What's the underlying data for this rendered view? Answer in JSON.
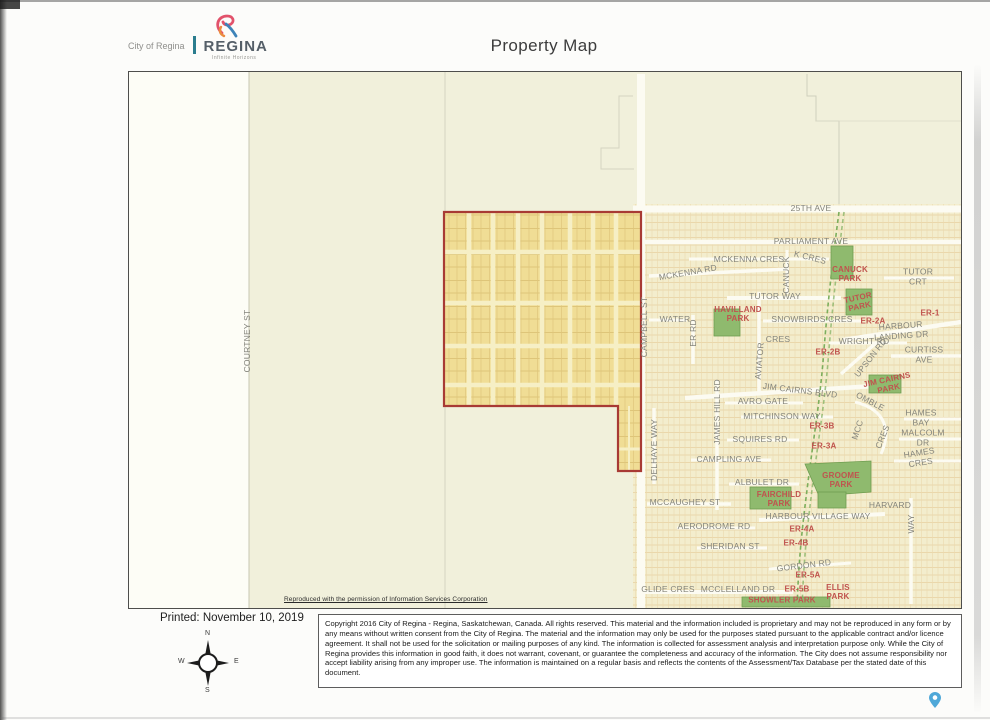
{
  "header": {
    "logo_small": "City of Regina",
    "logo_wordmark": "REGINA",
    "logo_tagline": "Infinite Horizons",
    "title": "Property Map"
  },
  "map": {
    "attribution": "Reproduced with the permission of Information Services Corporation",
    "labels": [
      {
        "t": "COURTNEY ST",
        "x": 119,
        "y": 269,
        "r": -90,
        "c": "s"
      },
      {
        "t": "CAMPBELL ST",
        "x": 516,
        "y": 255,
        "r": -90,
        "c": "s"
      },
      {
        "t": "25TH AVE",
        "x": 682,
        "y": 137,
        "r": 0,
        "c": "s"
      },
      {
        "t": "PARLIAMENT AVE",
        "x": 682,
        "y": 170,
        "r": 0,
        "c": "s"
      },
      {
        "t": "MCKENNA CRES",
        "x": 620,
        "y": 188,
        "r": 0,
        "c": "s"
      },
      {
        "t": "K CRES",
        "x": 681,
        "y": 186,
        "r": 14,
        "c": "s"
      },
      {
        "t": "CANUCK",
        "x": 658,
        "y": 203,
        "r": -90,
        "c": "s"
      },
      {
        "t": "MCKENNA RD",
        "x": 559,
        "y": 201,
        "r": -10,
        "c": "s"
      },
      {
        "t": "TUTOR CRT",
        "x": 789,
        "y": 205,
        "r": 0,
        "c": "s"
      },
      {
        "t": "TUTOR WAY",
        "x": 646,
        "y": 225,
        "r": 0,
        "c": "s"
      },
      {
        "t": "WATER",
        "x": 546,
        "y": 248,
        "r": 0,
        "c": "s"
      },
      {
        "t": "ER RD",
        "x": 565,
        "y": 261,
        "r": -90,
        "c": "s"
      },
      {
        "t": "SNOWBIRDS CRES",
        "x": 683,
        "y": 248,
        "r": 0,
        "c": "s"
      },
      {
        "t": "HARBOUR LANDING DR",
        "x": 772,
        "y": 259,
        "r": -4,
        "c": "s"
      },
      {
        "t": "WRIGHT RD",
        "x": 735,
        "y": 270,
        "r": 0,
        "c": "s"
      },
      {
        "t": "CRES",
        "x": 649,
        "y": 268,
        "r": 0,
        "c": "s"
      },
      {
        "t": "AVIATOR",
        "x": 631,
        "y": 289,
        "r": -85,
        "c": "s"
      },
      {
        "t": "CURTISS AVE",
        "x": 795,
        "y": 283,
        "r": 0,
        "c": "s"
      },
      {
        "t": "UPSON RD",
        "x": 742,
        "y": 286,
        "r": -52,
        "c": "s"
      },
      {
        "t": "JIM CAIRNS BLVD",
        "x": 671,
        "y": 319,
        "r": 7,
        "c": "s"
      },
      {
        "t": "AVRO GATE",
        "x": 634,
        "y": 330,
        "r": 0,
        "c": "s"
      },
      {
        "t": "OMBLE",
        "x": 741,
        "y": 330,
        "r": 28,
        "c": "s"
      },
      {
        "t": "MCC",
        "x": 729,
        "y": 358,
        "r": -72,
        "c": "s"
      },
      {
        "t": "CRES",
        "x": 754,
        "y": 365,
        "r": -68,
        "c": "s"
      },
      {
        "t": "MITCHINSON WAY",
        "x": 653,
        "y": 345,
        "r": 0,
        "c": "s"
      },
      {
        "t": "SQUIRES RD",
        "x": 631,
        "y": 368,
        "r": 0,
        "c": "s"
      },
      {
        "t": "CAMPLING AVE",
        "x": 600,
        "y": 388,
        "r": 0,
        "c": "s"
      },
      {
        "t": "JAMES HILL RD",
        "x": 589,
        "y": 340,
        "r": -90,
        "c": "s"
      },
      {
        "t": "DELHAYE WAY",
        "x": 526,
        "y": 378,
        "r": -90,
        "c": "s"
      },
      {
        "t": "HAMES BAY",
        "x": 792,
        "y": 346,
        "r": 0,
        "c": "s"
      },
      {
        "t": "MALCOLM DR",
        "x": 794,
        "y": 366,
        "r": 0,
        "c": "s"
      },
      {
        "t": "HAMES CRES",
        "x": 791,
        "y": 386,
        "r": -9,
        "c": "s"
      },
      {
        "t": "ALBULET DR",
        "x": 633,
        "y": 411,
        "r": 0,
        "c": "s"
      },
      {
        "t": "MCCAUGHEY ST",
        "x": 556,
        "y": 431,
        "r": 0,
        "c": "s"
      },
      {
        "t": "HARVARD",
        "x": 761,
        "y": 434,
        "r": 0,
        "c": "s"
      },
      {
        "t": "WAY",
        "x": 783,
        "y": 452,
        "r": -90,
        "c": "s"
      },
      {
        "t": "HARBOUR VILLAGE WAY",
        "x": 689,
        "y": 445,
        "r": 0,
        "c": "s"
      },
      {
        "t": "AERODROME RD",
        "x": 585,
        "y": 455,
        "r": 0,
        "c": "s"
      },
      {
        "t": "SHERIDAN ST",
        "x": 601,
        "y": 475,
        "r": 0,
        "c": "s"
      },
      {
        "t": "GORDON RD",
        "x": 675,
        "y": 494,
        "r": -7,
        "c": "s"
      },
      {
        "t": "GLIDE CRES",
        "x": 539,
        "y": 518,
        "r": 0,
        "c": "s"
      },
      {
        "t": "MCCLELLAND DR",
        "x": 609,
        "y": 518,
        "r": 0,
        "c": "s"
      },
      {
        "t": "CANUCK\nPARK",
        "x": 721,
        "y": 203,
        "r": 0,
        "c": "p"
      },
      {
        "t": "TUTOR\nPARK",
        "x": 730,
        "y": 231,
        "r": -12,
        "c": "p"
      },
      {
        "t": "HAVILLAND\nPARK",
        "x": 609,
        "y": 243,
        "r": 0,
        "c": "p"
      },
      {
        "t": "ER-1",
        "x": 801,
        "y": 242,
        "r": 0,
        "c": "p"
      },
      {
        "t": "ER-2A",
        "x": 744,
        "y": 250,
        "r": 0,
        "c": "p"
      },
      {
        "t": "ER-2B",
        "x": 699,
        "y": 281,
        "r": 0,
        "c": "p"
      },
      {
        "t": "JIM CAIRNS\nPARK",
        "x": 759,
        "y": 313,
        "r": -12,
        "c": "p"
      },
      {
        "t": "ER-3B",
        "x": 693,
        "y": 355,
        "r": 0,
        "c": "p"
      },
      {
        "t": "ER-3A",
        "x": 695,
        "y": 375,
        "r": 0,
        "c": "p"
      },
      {
        "t": "GROOME\nPARK",
        "x": 712,
        "y": 409,
        "r": 0,
        "c": "p"
      },
      {
        "t": "FAIRCHILD\nPARK",
        "x": 650,
        "y": 428,
        "r": 0,
        "c": "p"
      },
      {
        "t": "ER-4A",
        "x": 673,
        "y": 458,
        "r": 0,
        "c": "p"
      },
      {
        "t": "ER-4B",
        "x": 667,
        "y": 472,
        "r": 0,
        "c": "p"
      },
      {
        "t": "ER-5A",
        "x": 679,
        "y": 504,
        "r": 0,
        "c": "p"
      },
      {
        "t": "ER-5B",
        "x": 668,
        "y": 518,
        "r": 0,
        "c": "p"
      },
      {
        "t": "ELLIS\nPARK",
        "x": 709,
        "y": 521,
        "r": 0,
        "c": "p"
      },
      {
        "t": "SHOWLER PARK",
        "x": 653,
        "y": 529,
        "r": 0,
        "c": "p"
      }
    ],
    "colors": {
      "rural_background": "#f1f0db",
      "urban_block": "#f3edcd",
      "road_white": "#fcfbf2",
      "property_fill": "#f0dd95",
      "property_outline": "#a83a34",
      "park_green": "#8fba6e",
      "creek_green": "#7cae5c",
      "street_label_gray": "#84847b",
      "park_label_red": "#c0534e"
    }
  },
  "footer": {
    "printed_label": "Printed: November 10, 2019",
    "compass": {
      "n": "N",
      "e": "E",
      "s": "S",
      "w": "W"
    },
    "copyright": "Copyright 2016 City of Regina - Regina, Saskatchewan, Canada. All rights reserved. This material and the information included is proprietary and may not be reproduced in any form or by any means without written consent from the City of Regina. The material and the information may only be used for the purposes stated pursuant to the applicable contract and/or licence agreement. It shall not be used for the solicitation or mailing purposes of any kind. The information is collected for assessment analysis and interpretation purpose only. While the City of Regina provides this information in good faith, it does not warrant, covenant, or guarantee the completeness and accuracy of the information. The City does not assume responsibility nor accept liability arising from any improper use. The information is maintained on a regular basis and reflects the contents of the Assessment/Tax Database per the stated date of this document."
  },
  "pin_color": "#4fa8d8"
}
